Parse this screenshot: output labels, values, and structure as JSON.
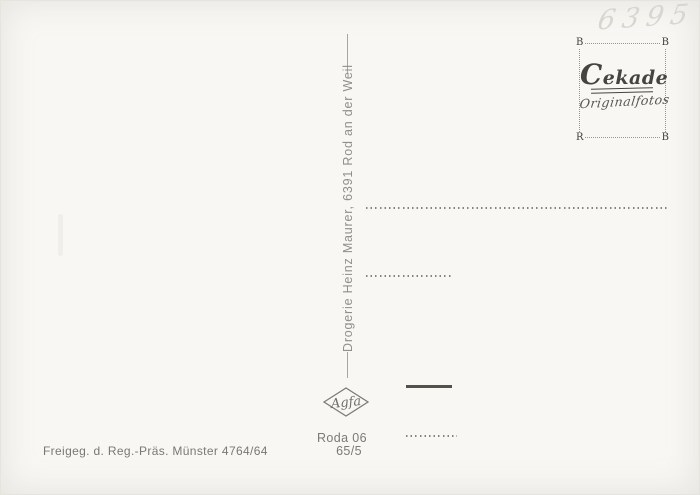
{
  "card": {
    "handwritten_number": "6395",
    "divider_text": "Drogerie Heinz Maurer, 6391 Rod an der Weil",
    "stamp_box": {
      "brand": "Cekade",
      "subtitle": "Originalfotos",
      "corner_top_left": "B",
      "corner_top_right": "B",
      "corner_bottom_left": "R",
      "corner_bottom_right": "B"
    },
    "film_logo": "Agfa",
    "print_code_line1": "Roda 06",
    "print_code_line2": "65/5",
    "approval_text": "Freigeg. d. Reg.-Präs. Münster 4764/64",
    "colors": {
      "paper": "#f8f7f4",
      "print_gray": "#8f8f8c",
      "dark_ink": "#45453f",
      "pencil_gray": "#d9d6cf"
    }
  }
}
